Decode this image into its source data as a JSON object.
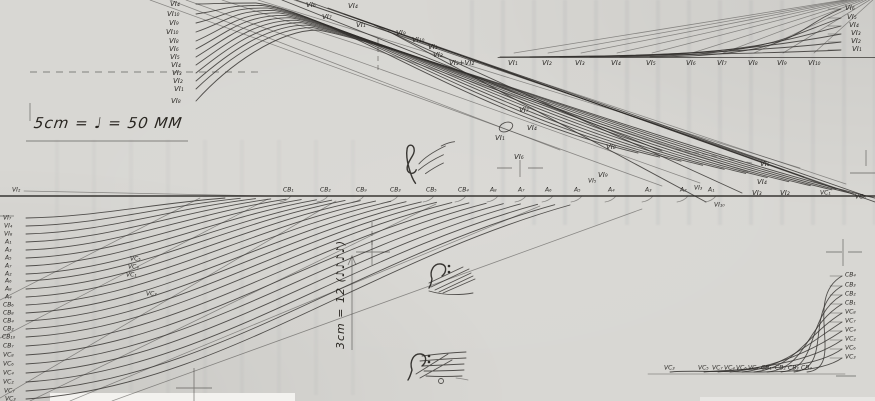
{
  "annotations": {
    "tempo": "5cm = ♩ = 50 MM",
    "span": "3cm = 12 (♪♪♪♪)"
  },
  "icons": {
    "treble_clef": "treble-clef",
    "bass_clef_mid": "bass-clef",
    "bass_clef_bottom": "bass-clef"
  },
  "score": {
    "top_left": [
      {
        "t": "VI₄",
        "x": 170,
        "y": 4
      },
      {
        "t": "VI₁₀",
        "x": 167,
        "y": 14
      },
      {
        "t": "VI₉",
        "x": 169,
        "y": 23
      },
      {
        "t": "VI₁₀",
        "x": 166,
        "y": 32
      },
      {
        "t": "VI₈",
        "x": 169,
        "y": 41
      },
      {
        "t": "VI₆",
        "x": 169,
        "y": 49
      },
      {
        "t": "VI₅",
        "x": 170,
        "y": 57
      },
      {
        "t": "VI₄",
        "x": 171,
        "y": 65
      },
      {
        "t": "VI₃",
        "x": 172,
        "y": 73
      },
      {
        "t": "VI₂",
        "x": 173,
        "y": 81
      },
      {
        "t": "VI₁",
        "x": 174,
        "y": 89
      },
      {
        "t": "VI₈",
        "x": 171,
        "y": 101
      }
    ],
    "top_center": [
      {
        "t": "VI₆",
        "x": 306,
        "y": 5
      },
      {
        "t": "VI₄",
        "x": 348,
        "y": 6
      },
      {
        "t": "VI₇",
        "x": 322,
        "y": 17
      },
      {
        "t": "VI₁",
        "x": 356,
        "y": 25
      },
      {
        "t": "VI₉",
        "x": 396,
        "y": 33
      },
      {
        "t": "VI₁₀",
        "x": 412,
        "y": 40
      },
      {
        "t": "VI₁",
        "x": 428,
        "y": 47
      },
      {
        "t": "VI₂",
        "x": 433,
        "y": 55
      },
      {
        "t": "VI₃+VI₂",
        "x": 449,
        "y": 63
      }
    ],
    "top_right_row": [
      {
        "t": "VI₁",
        "x": 508,
        "y": 63
      },
      {
        "t": "VI₂",
        "x": 542,
        "y": 63
      },
      {
        "t": "VI₃",
        "x": 575,
        "y": 63
      },
      {
        "t": "VI₄",
        "x": 611,
        "y": 63
      },
      {
        "t": "VI₅",
        "x": 646,
        "y": 63
      },
      {
        "t": "VI₆",
        "x": 686,
        "y": 63
      },
      {
        "t": "VI₇",
        "x": 717,
        "y": 63
      },
      {
        "t": "VI₈",
        "x": 748,
        "y": 63
      },
      {
        "t": "VI₉",
        "x": 777,
        "y": 63
      },
      {
        "t": "VI₁₀",
        "x": 808,
        "y": 63
      }
    ],
    "top_right_edge": [
      {
        "t": "VI₆",
        "x": 845,
        "y": 8
      },
      {
        "t": "VI₅",
        "x": 847,
        "y": 17
      },
      {
        "t": "VI₄",
        "x": 849,
        "y": 25
      },
      {
        "t": "VI₃",
        "x": 851,
        "y": 33
      },
      {
        "t": "VI₂",
        "x": 851,
        "y": 41
      },
      {
        "t": "VI₁",
        "x": 852,
        "y": 49
      }
    ],
    "mid_bundle": [
      {
        "t": "VI₇",
        "x": 519,
        "y": 110
      },
      {
        "t": "VI₄",
        "x": 527,
        "y": 128
      },
      {
        "t": "VI₁",
        "x": 495,
        "y": 138
      },
      {
        "t": "VI₆",
        "x": 514,
        "y": 157
      },
      {
        "t": "VI₈",
        "x": 606,
        "y": 147
      },
      {
        "t": "VI₉",
        "x": 598,
        "y": 175
      },
      {
        "t": "VI₅",
        "x": 760,
        "y": 164
      },
      {
        "t": "VI₄",
        "x": 757,
        "y": 182
      },
      {
        "t": "VI₃",
        "x": 752,
        "y": 193
      },
      {
        "t": "VI₂",
        "x": 780,
        "y": 193
      }
    ],
    "centerline_above": [
      {
        "t": "CB₁",
        "x": 283,
        "y": 190
      },
      {
        "t": "CB₂",
        "x": 320,
        "y": 190
      },
      {
        "t": "CB₉",
        "x": 356,
        "y": 190
      },
      {
        "t": "CB₃",
        "x": 390,
        "y": 190
      },
      {
        "t": "CB₅",
        "x": 426,
        "y": 190
      },
      {
        "t": "CB₄",
        "x": 458,
        "y": 190
      },
      {
        "t": "A₈",
        "x": 490,
        "y": 190
      },
      {
        "t": "A₇",
        "x": 518,
        "y": 190
      },
      {
        "t": "A₆",
        "x": 545,
        "y": 190
      },
      {
        "t": "A₅",
        "x": 574,
        "y": 190
      },
      {
        "t": "VI₅",
        "x": 588,
        "y": 181
      },
      {
        "t": "A₄",
        "x": 608,
        "y": 190
      },
      {
        "t": "A₃",
        "x": 645,
        "y": 190
      },
      {
        "t": "A₂",
        "x": 680,
        "y": 190
      },
      {
        "t": "VI₃",
        "x": 694,
        "y": 188
      },
      {
        "t": "A₁",
        "x": 708,
        "y": 190
      }
    ],
    "centerline_right": [
      {
        "t": "VI₁₀",
        "x": 714,
        "y": 205
      },
      {
        "t": "VC₁",
        "x": 820,
        "y": 193
      },
      {
        "t": "VC₆",
        "x": 855,
        "y": 197
      }
    ],
    "left_column": [
      {
        "t": "VI₂",
        "x": 12,
        "y": 190
      },
      {
        "t": "VI₇",
        "x": 3,
        "y": 218
      },
      {
        "t": "VI₄",
        "x": 4,
        "y": 226
      },
      {
        "t": "VI₈",
        "x": 4,
        "y": 234
      },
      {
        "t": "A₁",
        "x": 5,
        "y": 242
      },
      {
        "t": "A₃",
        "x": 5,
        "y": 250
      },
      {
        "t": "A₅",
        "x": 5,
        "y": 258
      },
      {
        "t": "A₇",
        "x": 5,
        "y": 266
      },
      {
        "t": "A₂",
        "x": 5,
        "y": 274
      },
      {
        "t": "A₆",
        "x": 5,
        "y": 281
      },
      {
        "t": "A₈",
        "x": 5,
        "y": 289
      },
      {
        "t": "A₄",
        "x": 5,
        "y": 297
      },
      {
        "t": "CB₆",
        "x": 3,
        "y": 305
      },
      {
        "t": "CB₈",
        "x": 3,
        "y": 313
      },
      {
        "t": "CB₄",
        "x": 3,
        "y": 321
      },
      {
        "t": "CB₂",
        "x": 3,
        "y": 329
      },
      {
        "t": "CB₁₀",
        "x": 2,
        "y": 337
      },
      {
        "t": "CB₇",
        "x": 3,
        "y": 346
      },
      {
        "t": "VC₈",
        "x": 3,
        "y": 355
      },
      {
        "t": "VC₆",
        "x": 3,
        "y": 364
      },
      {
        "t": "VC₄",
        "x": 3,
        "y": 373
      },
      {
        "t": "VC₂",
        "x": 3,
        "y": 382
      },
      {
        "t": "VC₇",
        "x": 4,
        "y": 391
      },
      {
        "t": "VC₃",
        "x": 5,
        "y": 399
      }
    ],
    "mid_left": [
      {
        "t": "VC₅",
        "x": 130,
        "y": 259
      },
      {
        "t": "VC₄",
        "x": 128,
        "y": 267
      },
      {
        "t": "VC₁",
        "x": 126,
        "y": 275
      },
      {
        "t": "VC₃",
        "x": 146,
        "y": 294
      }
    ],
    "bottom_row": [
      {
        "t": "VC₃",
        "x": 664,
        "y": 368
      },
      {
        "t": "VC₅",
        "x": 698,
        "y": 368
      },
      {
        "t": "VC₇",
        "x": 712,
        "y": 368
      },
      {
        "t": "VC₄",
        "x": 724,
        "y": 368
      },
      {
        "t": "VC₆",
        "x": 736,
        "y": 368
      },
      {
        "t": "VC₈",
        "x": 748,
        "y": 368
      },
      {
        "t": "CB₁",
        "x": 761,
        "y": 368
      },
      {
        "t": "CB₂",
        "x": 775,
        "y": 368
      },
      {
        "t": "CB₃",
        "x": 788,
        "y": 368
      },
      {
        "t": "CB₄",
        "x": 801,
        "y": 368
      }
    ],
    "bottom_right_edge": [
      {
        "t": "CB₄",
        "x": 845,
        "y": 275
      },
      {
        "t": "CB₃",
        "x": 845,
        "y": 285
      },
      {
        "t": "CB₂",
        "x": 845,
        "y": 294
      },
      {
        "t": "CB₁",
        "x": 845,
        "y": 303
      },
      {
        "t": "VC₈",
        "x": 845,
        "y": 312
      },
      {
        "t": "VC₇",
        "x": 845,
        "y": 321
      },
      {
        "t": "VC₄",
        "x": 845,
        "y": 330
      },
      {
        "t": "VC₂",
        "x": 845,
        "y": 339
      },
      {
        "t": "VC₆",
        "x": 845,
        "y": 348
      },
      {
        "t": "VC₃",
        "x": 845,
        "y": 357
      }
    ]
  }
}
